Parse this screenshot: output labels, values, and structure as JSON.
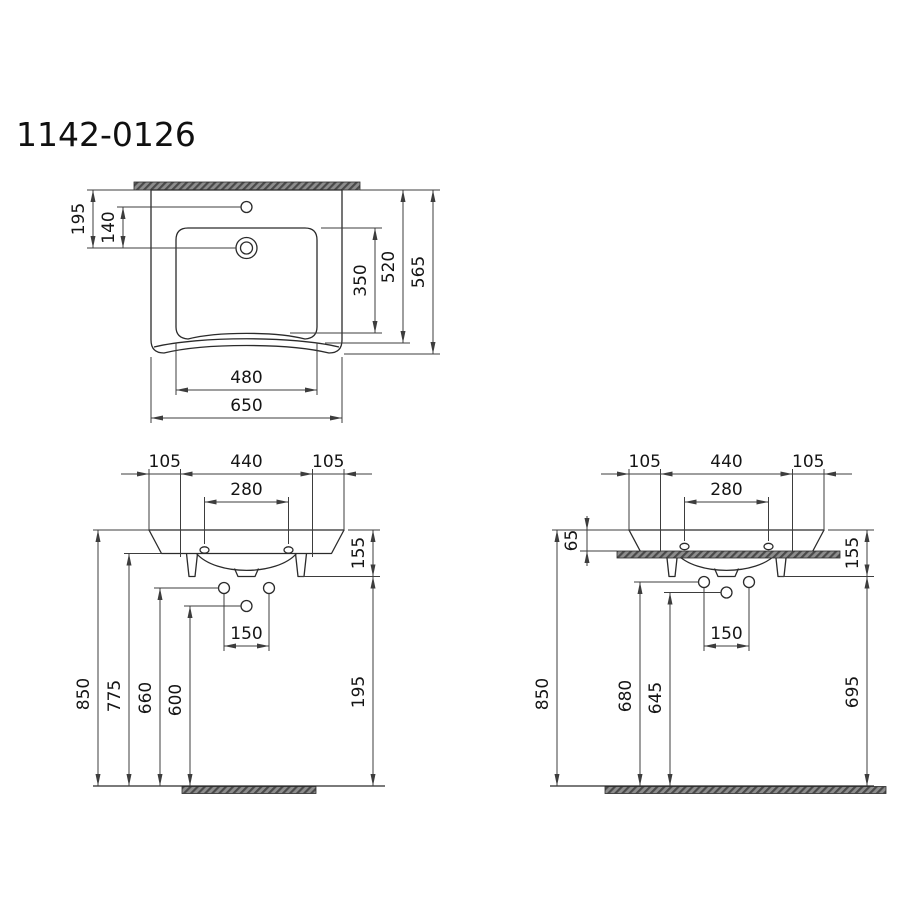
{
  "title": "1142-0126",
  "plan": {
    "wall_to_tap": "195",
    "tap_hole_offset": "140",
    "bowl_depth": "350",
    "wall_to_front_edge": "520",
    "overall_depth": "565",
    "bowl_width": "480",
    "overall_width": "650"
  },
  "front_wall": {
    "edge_left": "105",
    "fixing_width": "440",
    "edge_right": "105",
    "tap_hole_spacing": "280",
    "rim_height": "155",
    "overall_height": "850",
    "fixing_holes_height": "775",
    "supply_height": "660",
    "drain_height": "600",
    "under_clearance": "195",
    "supply_spacing": "150"
  },
  "front_counter": {
    "edge_left": "105",
    "fixing_width": "440",
    "edge_right": "105",
    "tap_hole_spacing": "280",
    "above_counter": "65",
    "rim_height": "155",
    "overall_height": "850",
    "supply_height": "680",
    "drain_height": "645",
    "under_clearance": "695",
    "supply_spacing": "150"
  }
}
